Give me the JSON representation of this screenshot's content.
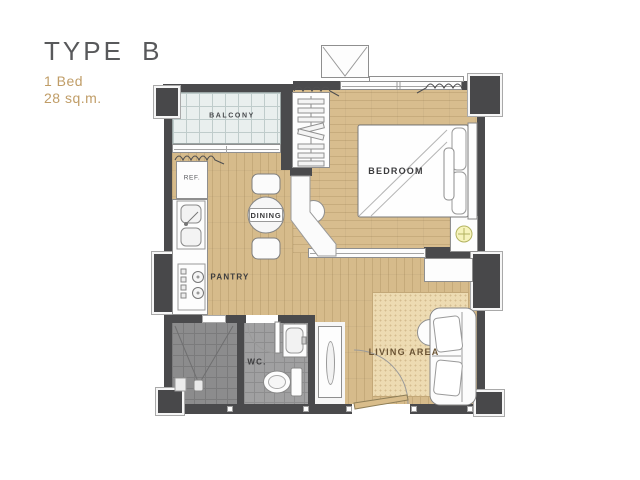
{
  "title": {
    "type": "TYPE B",
    "bedrooms": "1 Bed",
    "area": "28 sq.m."
  },
  "labels": {
    "balcony": "BALCONY",
    "bedroom": "BEDROOM",
    "dining": "DINING",
    "pantry": "PANTRY",
    "wc": "WC.",
    "living_area": "LIVING AREA",
    "refrigerator": "REF."
  },
  "colors": {
    "title_text": "#58595b",
    "accent_text": "#c09d67",
    "wall": "#4a4a4c",
    "wood_floor": "#d6bb8b",
    "balcony_tile": "#e9efee",
    "wet_room_tile": "#9f9fa0",
    "shower_tile": "#8c8c8d",
    "rug": "#eddbb2",
    "label_text": "#3c3c3e",
    "living_label_text": "#6b5434",
    "lamp": "#f6f3bb"
  }
}
